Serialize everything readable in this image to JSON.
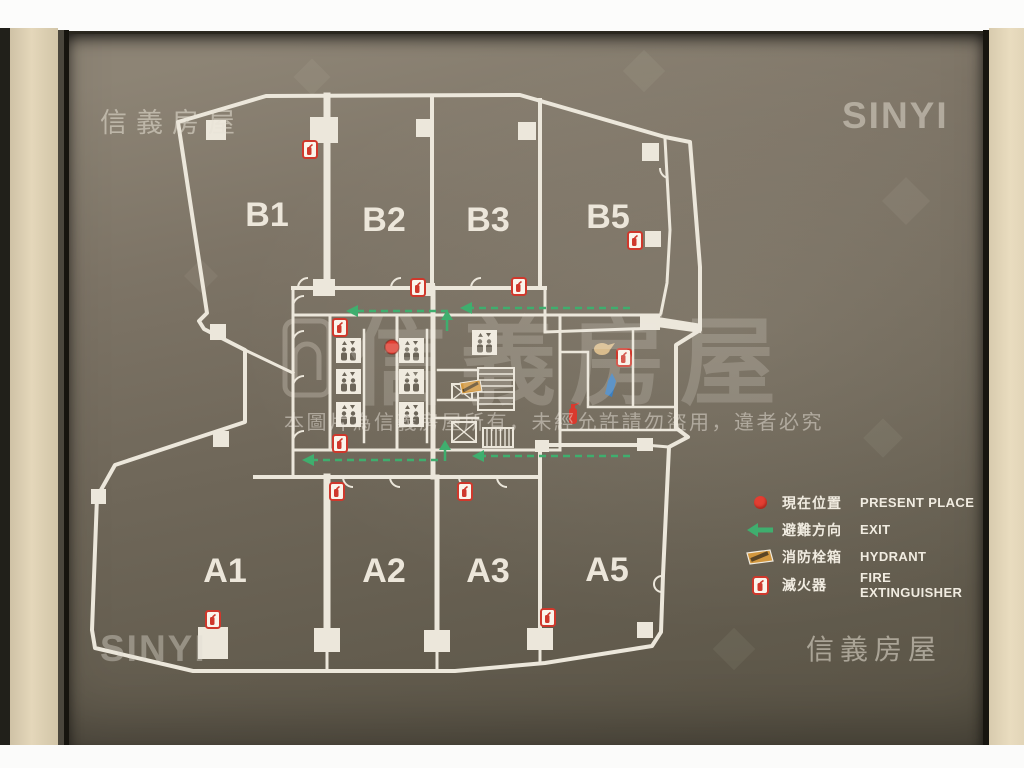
{
  "watermarks": {
    "top_left": "信義房屋",
    "top_right": "SINYI",
    "bottom_left": "SINYI",
    "bottom_right": "信義房屋",
    "center_brand": "信義房屋",
    "notice": "本圖片為信義房屋所有，未經允許請勿盜用，違者必究"
  },
  "plan": {
    "rooms": [
      "B1",
      "B2",
      "B3",
      "B5",
      "A1",
      "A2",
      "A3",
      "A5"
    ]
  },
  "legend": {
    "items": [
      {
        "icon": "present-place-dot",
        "zh": "現在位置",
        "en": "PRESENT PLACE"
      },
      {
        "icon": "exit-arrow",
        "zh": "避難方向",
        "en": "EXIT"
      },
      {
        "icon": "hydrant-box",
        "zh": "消防栓箱",
        "en": "HYDRANT"
      },
      {
        "icon": "fire-extinguisher-box",
        "zh": "滅火器",
        "en": "FIRE EXTINGUISHER"
      }
    ]
  },
  "colors": {
    "sign_background": "#6f6759",
    "plan_line": "#ece7db",
    "exit_green": "#3fae6e",
    "alarm_red": "#d93a2e",
    "hydrant_orange": "#d2973e",
    "present_place_red": "#e23e32",
    "marker_blue": "#3a7fc1"
  }
}
